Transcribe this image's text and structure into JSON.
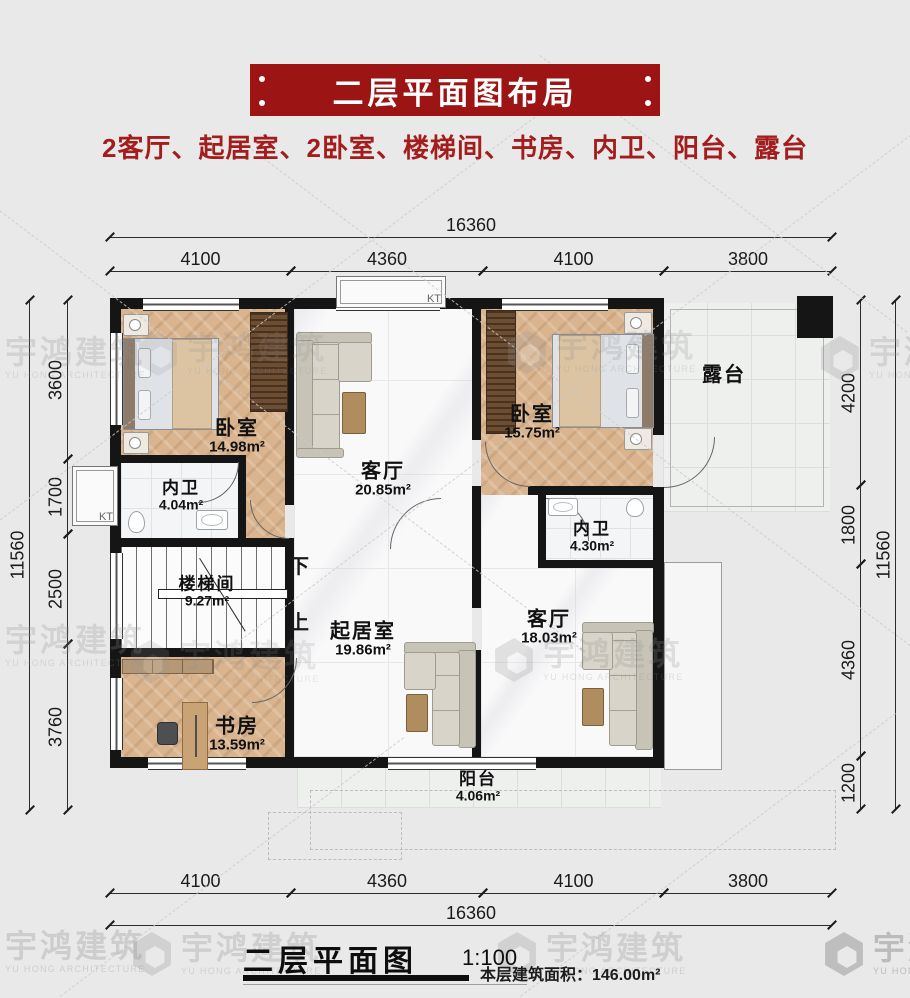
{
  "header": {
    "banner_title": "二层平面图布局",
    "subtitle": "2客厅、起居室、2卧室、楼梯间、书房、内卫、阳台、露台"
  },
  "watermark": {
    "cn": "宇鸿建筑",
    "en": "YU HONG ARCHITECTURE"
  },
  "plan": {
    "kt_label": "KT",
    "stairs": {
      "name": "楼梯间",
      "area": "9.27m²",
      "down": "下",
      "up": "上"
    },
    "rooms": {
      "bedroom1": {
        "name": "卧室",
        "area": "14.98m²"
      },
      "living1": {
        "name": "客厅",
        "area": "20.85m²"
      },
      "bedroom2": {
        "name": "卧室",
        "area": "15.75m²"
      },
      "terrace": {
        "name": "露台"
      },
      "bath1": {
        "name": "内卫",
        "area": "4.04m²"
      },
      "bath2": {
        "name": "内卫",
        "area": "4.30m²"
      },
      "family": {
        "name": "起居室",
        "area": "19.86m²"
      },
      "living2": {
        "name": "客厅",
        "area": "18.03m²"
      },
      "study": {
        "name": "书房",
        "area": "13.59m²"
      },
      "balcony": {
        "name": "阳台",
        "area": "4.06m²"
      }
    },
    "dimensions": {
      "top_total": "16360",
      "top": [
        "4100",
        "4360",
        "4100",
        "3800"
      ],
      "bottom": [
        "4100",
        "4360",
        "4100",
        "3800"
      ],
      "bottom_total": "16360",
      "left": [
        "3600",
        "1700",
        "2500",
        "3760"
      ],
      "left_total": "11560",
      "right": [
        "4200",
        "1800",
        "4360",
        "1200"
      ],
      "right_total": "11560"
    }
  },
  "footer": {
    "title": "二层平面图",
    "scale": "1:100",
    "area_note": "本层建筑面积：146.00m²"
  },
  "colors": {
    "banner_red": "#9c1414",
    "subtitle_red": "#a31d1d",
    "wall_black": "#151515",
    "wood_floor": "#d9b48e",
    "marble_floor": "#f9f9fa",
    "terrace_tile": "#eef0ee"
  }
}
